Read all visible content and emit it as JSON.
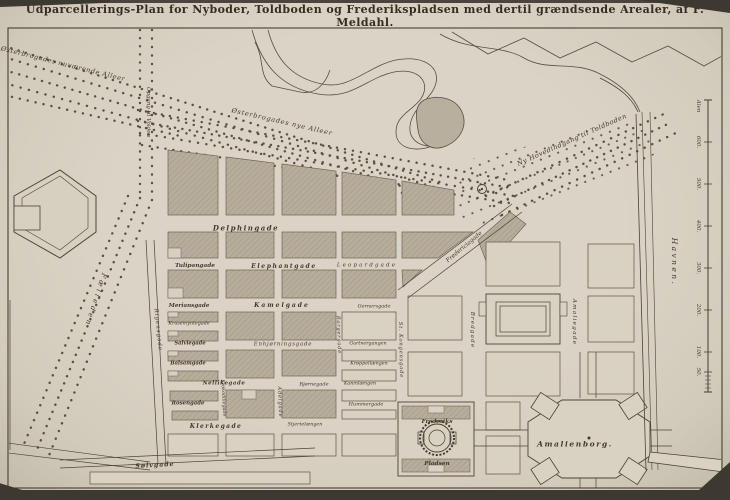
{
  "title": "Udparcellerings-Plan for Nyboder, Toldboden og Frederikspladsen med dertil grændsende Arealer, af F. Meldahl.",
  "labels": {
    "oesterbro_nuv": "Østerbrogades nuværende Alleer",
    "oesterbro_nye": "Østerbrogades nye Alleer",
    "ny_hovedindgang": "Ny Hovedindgang til Toldboden",
    "opgang_volden": "Opgang til Volden",
    "faelleden": "Fælleden",
    "fredericiagade": "Fredericiagade",
    "delphingade": "Delphingade",
    "tulipangade": "Tulipangade",
    "elephantgade": "Elephantgade",
    "leopardgade": "Leopardgade",
    "meriansgade": "Meriansgade",
    "kamelgade": "Kamelgade",
    "gernersgade": "Gernersgade",
    "krusemyntegade": "Krusemyntegade",
    "salviegade": "Salviegade",
    "enhjoerningsgade": "Enhjørningsgade",
    "gartnergangen": "Gartnergangen",
    "balsamgade": "Balsamgade",
    "kroeppellaengen": "Krøppellængen",
    "nellikegade": "Nellikegade",
    "bjoernegade": "Bjørnegade",
    "kaninlaengen": "Kaninlængen",
    "rosengade": "Rosengade",
    "hummergade": "Hummergade",
    "klerkegade": "Klerkegade",
    "stjertelaengen": "Stjertelængen",
    "soelvgade": "Sølvgade",
    "rigensgade": "Rigensgade",
    "krokodillegade": "Krokodillegade",
    "adelgade": "Adelgade",
    "borgergade": "Borgergade",
    "st_kongensgade": "St. Kongensgade",
    "bredgade": "Bredgade",
    "amaliegade": "Amaliegade",
    "havnen": "Havnen.",
    "frederiks": "Frederiks",
    "pladsen": "Pladsen",
    "amalienborg": "Amalienborg."
  },
  "scale": {
    "ticks": [
      "Alen",
      "600.",
      "500.",
      "400.",
      "300.",
      "200.",
      "100.",
      "50."
    ]
  },
  "colors": {
    "paper": "#d7cfc0",
    "ink": "#3e382f",
    "block_shading": "#b6ad9c"
  }
}
